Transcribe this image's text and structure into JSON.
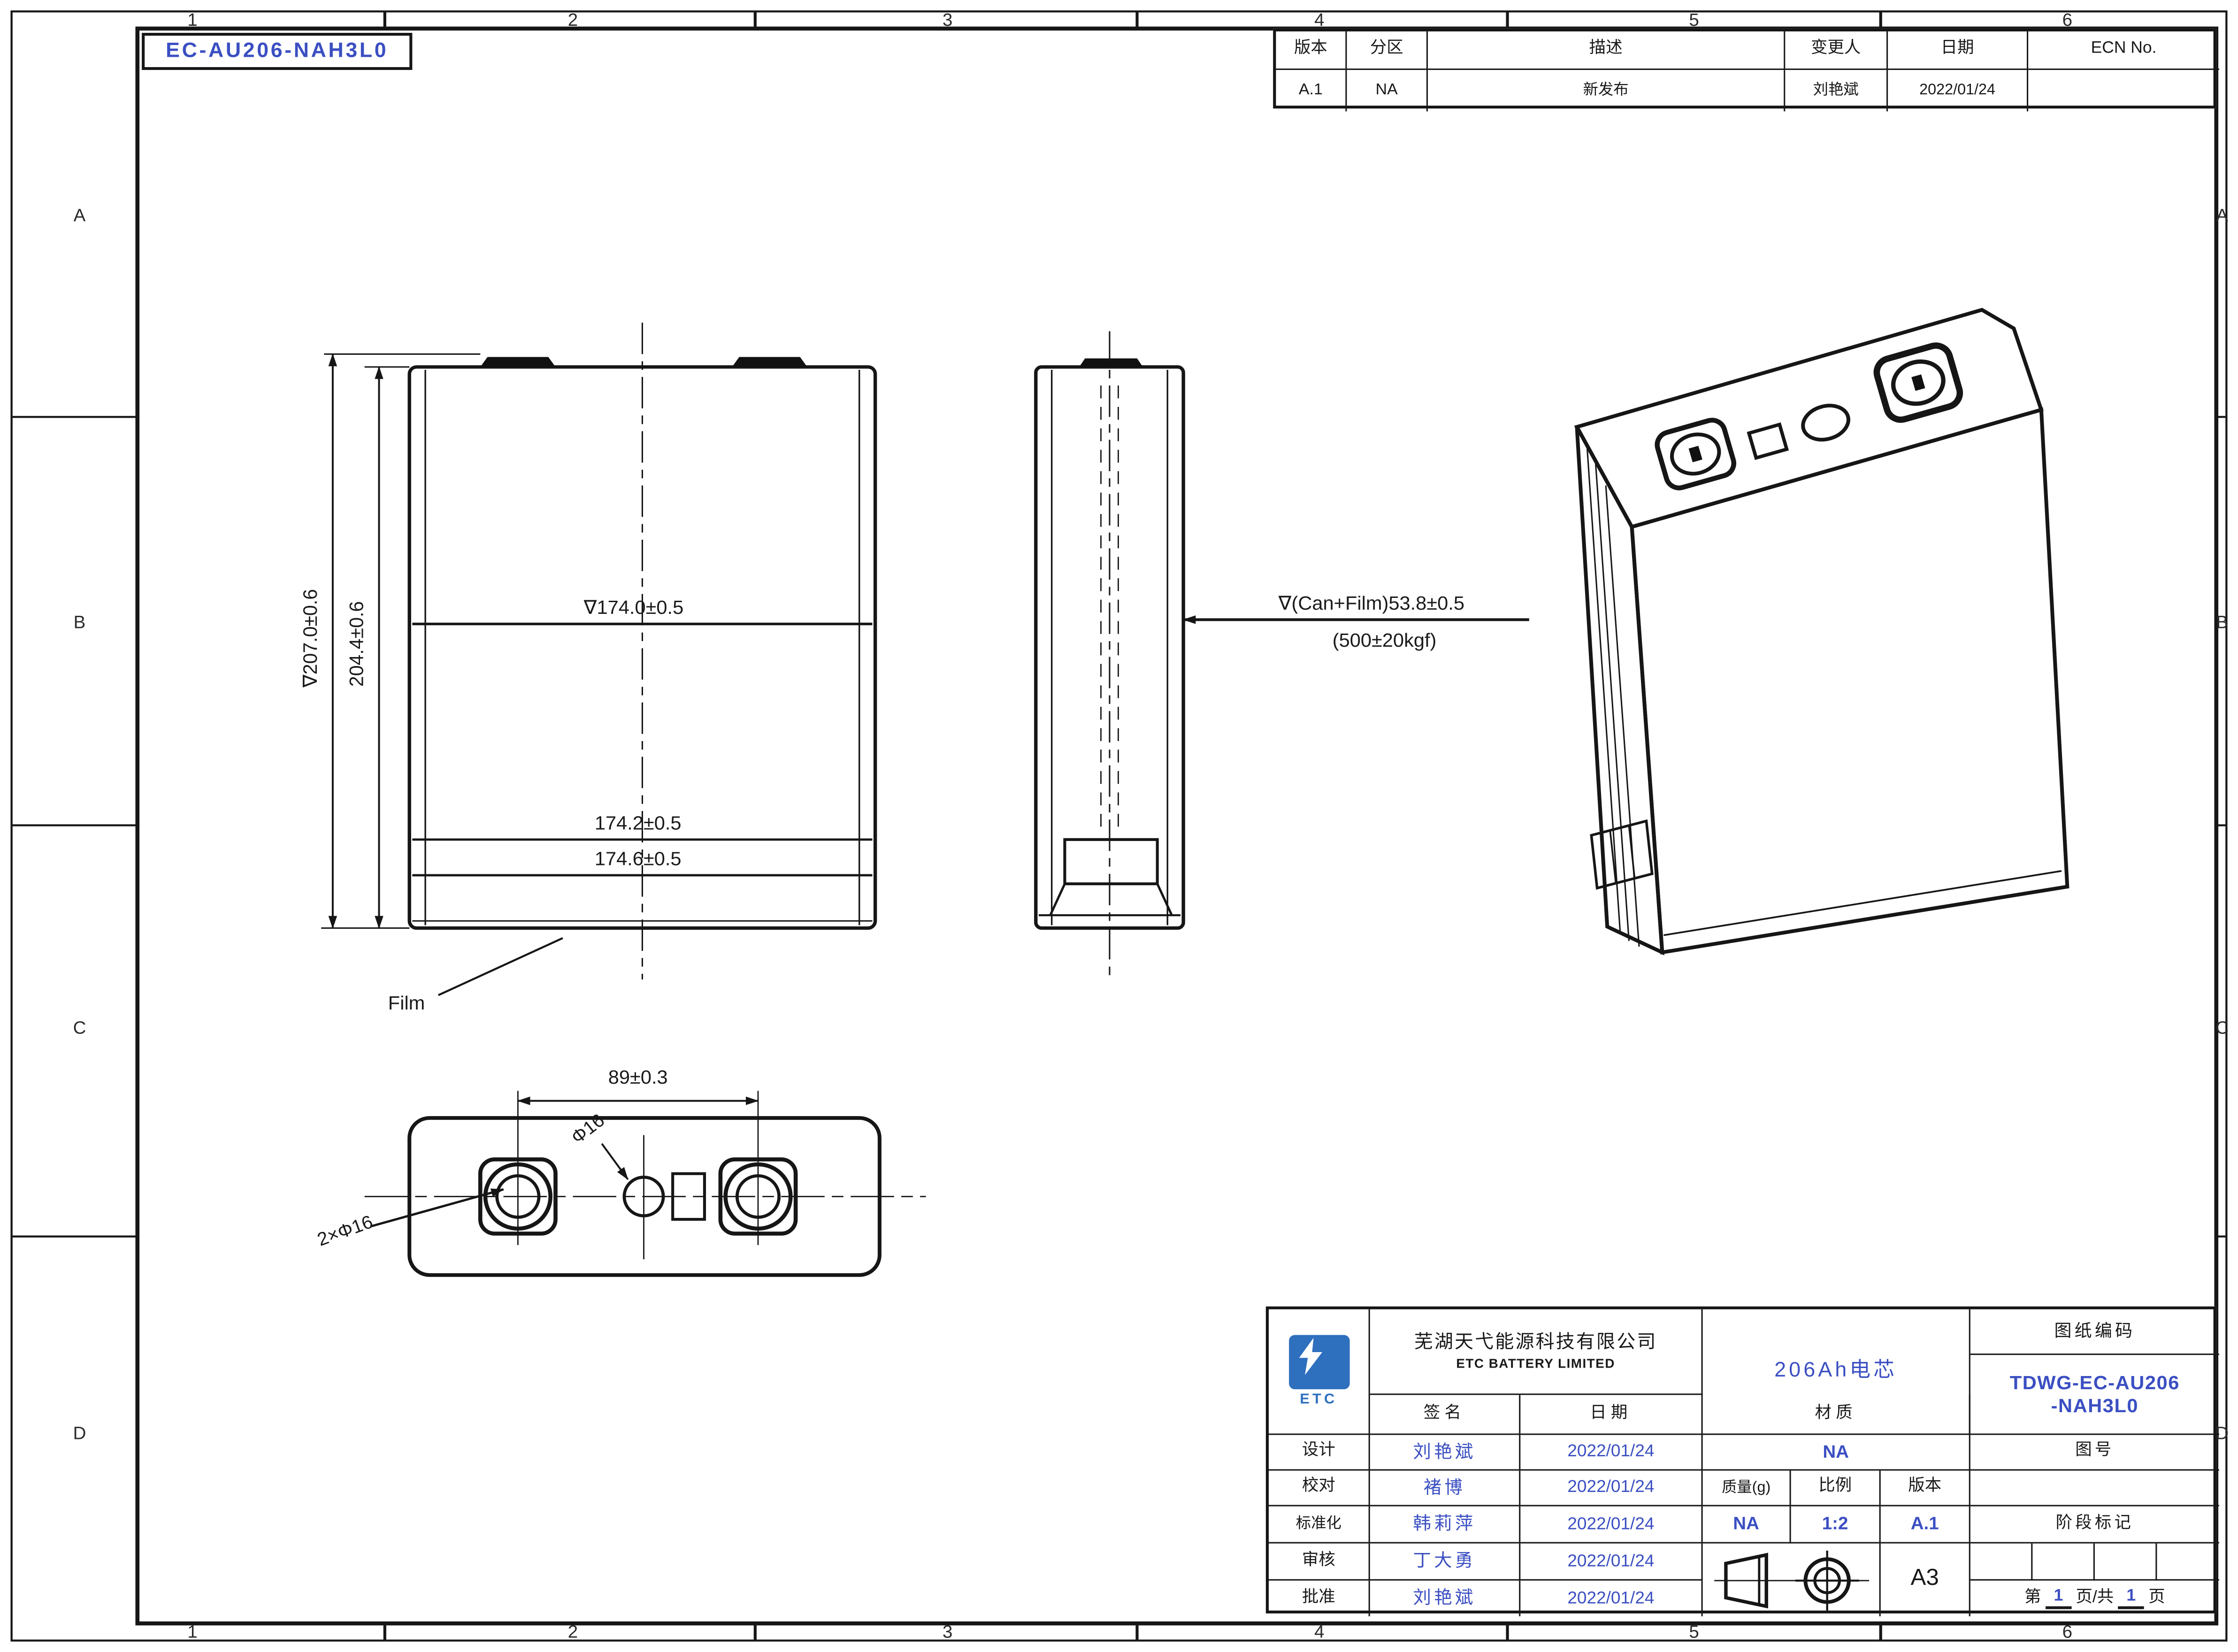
{
  "sheet": {
    "doc_number": "EC-AU206-NAH3L0",
    "zones_top": [
      "1",
      "2",
      "3",
      "4",
      "5",
      "6"
    ],
    "zones_side": [
      "A",
      "B",
      "C",
      "D"
    ]
  },
  "revision": {
    "headers": [
      "版本",
      "分区",
      "描述",
      "变更人",
      "日期",
      "ECN No."
    ],
    "row": [
      "A.1",
      "NA",
      "新发布",
      "刘艳斌",
      "2022/01/24",
      ""
    ]
  },
  "views": {
    "front": {
      "dim_overall": "∇207.0±0.6",
      "dim_body": "204.4±0.6",
      "dim_mid": "∇174.0±0.5",
      "dim_lower1": "174.2±0.5",
      "dim_lower2": "174.6±0.5",
      "film_label": "Film"
    },
    "side": {
      "dim_can": "∇(Can+Film)53.8±0.5",
      "dim_force": "(500±20kgf)"
    },
    "bottom": {
      "dim_pitch": "89±0.3",
      "vent": "Φ16",
      "terminals": "2×Φ16"
    }
  },
  "title_block": {
    "logo_text": "ETC",
    "company_cn": "芜湖天弋能源科技有限公司",
    "company_en": "ETC BATTERY LIMITED",
    "product_name": "206Ah电芯",
    "code_label": "图纸编码",
    "code_line1": "TDWG-EC-AU206",
    "code_line2": "-NAH3L0",
    "sign_label": "签名",
    "date_label": "日期",
    "material_label": "材质",
    "material_value": "NA",
    "drawing_no_label": "图号",
    "mass_label": "质量(g)",
    "scale_label": "比例",
    "version_label": "版本",
    "mass_value": "NA",
    "scale_value": "1:2",
    "version_value": "A.1",
    "stage_label": "阶段标记",
    "paper_size": "A3",
    "page_label_1": "第",
    "page_num1": "1",
    "page_label_2": "页/共",
    "page_num2": "1",
    "page_label_3": "页",
    "rows": [
      {
        "role": "设计",
        "name": "刘艳斌",
        "date": "2022/01/24"
      },
      {
        "role": "校对",
        "name": "褚博",
        "date": "2022/01/24"
      },
      {
        "role": "标准化",
        "name": "韩莉萍",
        "date": "2022/01/24"
      },
      {
        "role": "审核",
        "name": "丁大勇",
        "date": "2022/01/24"
      },
      {
        "role": "批准",
        "name": "刘艳斌",
        "date": "2022/01/24"
      }
    ]
  },
  "colors": {
    "accent_blue": "#3b4fc2",
    "logo_blue": "#2e6fbe",
    "line": "#161616"
  }
}
